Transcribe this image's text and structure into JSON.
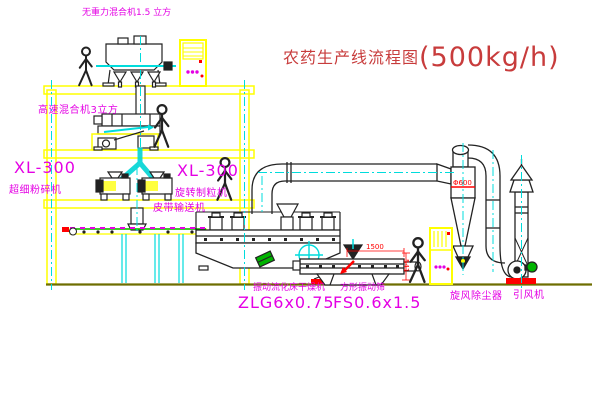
{
  "title": {
    "text": "农药生产线流程图",
    "capacity": "(500kg/h)"
  },
  "labels": {
    "gravity_mixer": "无重力混合机1.5 立方",
    "high_speed_mixer": "高速混合机3立方",
    "mill_model": "XL-300",
    "mill_name": "超细粉碎机",
    "granulator_model": "XL-300",
    "granulator_name": "旋转制粒机",
    "belt_conveyor": "皮带输送机",
    "dryer_name": "振动流化床干燥机",
    "dryer_model": "ZLG6x0.75",
    "screen_name": "方形振动筛",
    "screen_model": "FS0.6x1.5",
    "cyclone": "旋风除尘器",
    "fan": "引风机"
  },
  "dimensions": {
    "screen_length": "1500",
    "screen_side": "541",
    "cyclone_dia": "Φ600"
  },
  "colors": {
    "structure_yellow": "#ffff00",
    "centerline_cyan": "#00dcdc",
    "label_magenta": "#e400e4",
    "title_red": "#c83c3c",
    "dimension_red": "#ff0000",
    "machine_outline": "#222222",
    "ground_olive": "#6e6e00",
    "accent_green": "#00b400"
  }
}
